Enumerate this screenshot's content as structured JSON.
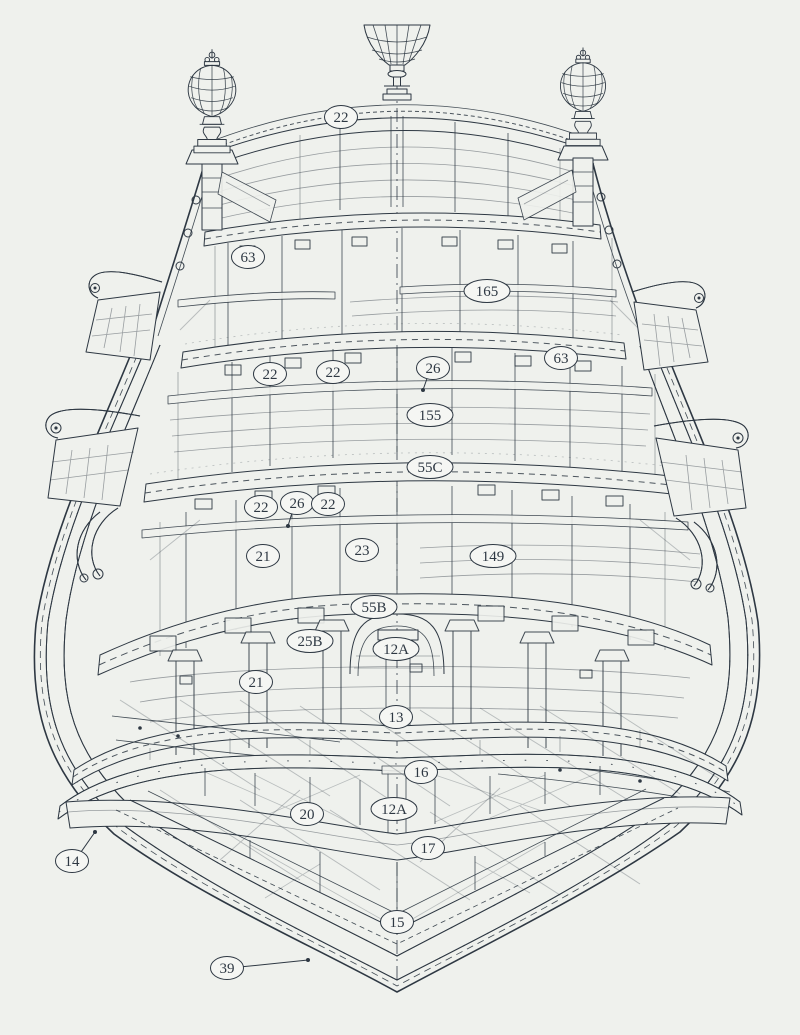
{
  "page": {
    "description": "Scanned technical drawing: cross-section of a ship's stern (sailing warship) with three stern lanterns, carved taffrail arch, multiple deck levels and numbered part labels in ovals",
    "ink_color": "#2e3843",
    "paper_color": "#eff1ed",
    "label_fill_color": "#f5f6f3",
    "paper_edge_color": "#fbfcfa"
  },
  "diagram": {
    "type": "technical-drawing",
    "subject": "Ship stern cross-section with numbered part callouts",
    "label_style": {
      "stroke_width": 1.5,
      "font_size": 15,
      "ry": 11.5,
      "rx_small": 16.5,
      "rx_wide": 23
    },
    "labels": [
      {
        "text": "22",
        "x": 341,
        "y": 117
      },
      {
        "text": "63",
        "x": 248,
        "y": 257
      },
      {
        "text": "165",
        "x": 487,
        "y": 291
      },
      {
        "text": "63",
        "x": 561,
        "y": 358
      },
      {
        "text": "26",
        "x": 433,
        "y": 368,
        "leader": {
          "x": 423,
          "y": 390
        }
      },
      {
        "text": "22",
        "x": 270,
        "y": 374
      },
      {
        "text": "22",
        "x": 333,
        "y": 372
      },
      {
        "text": "155",
        "x": 430,
        "y": 415
      },
      {
        "text": "55C",
        "x": 430,
        "y": 467
      },
      {
        "text": "22",
        "x": 261,
        "y": 507
      },
      {
        "text": "26",
        "x": 297,
        "y": 503,
        "leader": {
          "x": 288,
          "y": 526
        }
      },
      {
        "text": "22",
        "x": 328,
        "y": 504
      },
      {
        "text": "21",
        "x": 263,
        "y": 556
      },
      {
        "text": "23",
        "x": 362,
        "y": 550
      },
      {
        "text": "149",
        "x": 493,
        "y": 556
      },
      {
        "text": "55B",
        "x": 374,
        "y": 607
      },
      {
        "text": "25B",
        "x": 310,
        "y": 641
      },
      {
        "text": "12A",
        "x": 396,
        "y": 649
      },
      {
        "text": "21",
        "x": 256,
        "y": 682
      },
      {
        "text": "13",
        "x": 396,
        "y": 717
      },
      {
        "text": "16",
        "x": 421,
        "y": 772
      },
      {
        "text": "12A",
        "x": 394,
        "y": 809
      },
      {
        "text": "20",
        "x": 307,
        "y": 814
      },
      {
        "text": "17",
        "x": 428,
        "y": 848
      },
      {
        "text": "14",
        "x": 72,
        "y": 861,
        "leader": {
          "x": 95,
          "y": 832
        }
      },
      {
        "text": "15",
        "x": 397,
        "y": 922
      },
      {
        "text": "39",
        "x": 227,
        "y": 968,
        "leader": {
          "x": 308,
          "y": 960
        }
      }
    ]
  }
}
